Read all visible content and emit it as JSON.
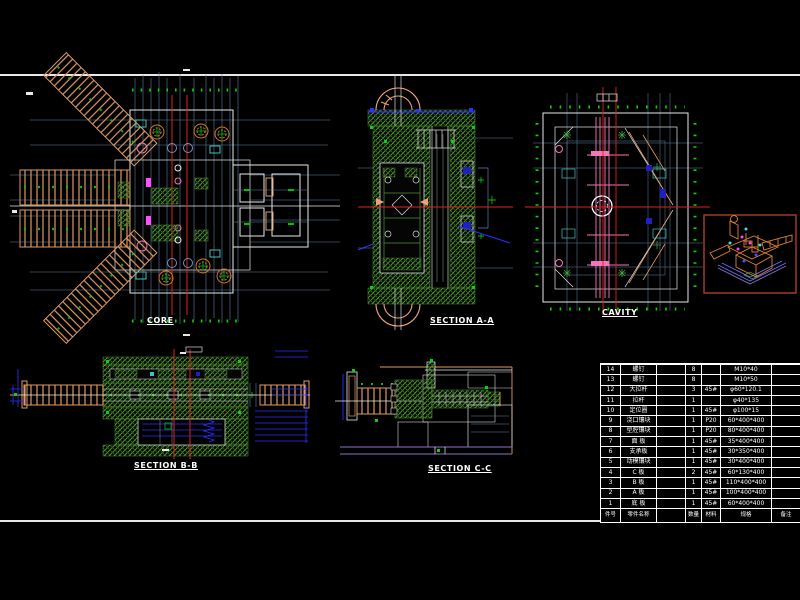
{
  "sheet": {
    "background": "#000000",
    "frame_color": "#FFFFFF"
  },
  "views": {
    "core": {
      "label": "CORE"
    },
    "section_aa": {
      "label": "SECTION A-A"
    },
    "cavity": {
      "label": "CAVITY"
    },
    "section_bb": {
      "label": "SECTION B-B"
    },
    "section_cc": {
      "label": "SECTION C-C"
    }
  },
  "palette": {
    "hatch_green": "#4C9130",
    "bright_green": "#00D800",
    "arm_tan": "#DE9A62",
    "arc_salmon": "#F0A078",
    "gear_orange": "#D97420",
    "centerline_red": "#E02020",
    "dim_blue": "#2E2EFF",
    "aux_blue_gray": "#5F7F9F",
    "runner_pink": "#F277B6",
    "magenta": "#FF50FF",
    "iso_border_red": "#9E3A28",
    "purple": "#8F6FD0"
  },
  "bom": {
    "headers": {
      "no": "件号",
      "name": "零件名称",
      "drawing": "",
      "qty": "数量",
      "material": "材料",
      "spec": "规格",
      "remark": "备注"
    },
    "rows": [
      {
        "no": "14",
        "name": "螺钉",
        "qty": "8",
        "material": "",
        "spec": "M10*40",
        "remark": ""
      },
      {
        "no": "13",
        "name": "螺钉",
        "qty": "8",
        "material": "",
        "spec": "M10*50",
        "remark": ""
      },
      {
        "no": "12",
        "name": "大拉杆",
        "qty": "3",
        "material": "45#",
        "spec": "φ60*120.1",
        "remark": ""
      },
      {
        "no": "11",
        "name": "拉杆",
        "qty": "1",
        "material": "",
        "spec": "φ40*135",
        "remark": ""
      },
      {
        "no": "10",
        "name": "定位圈",
        "qty": "1",
        "material": "45#",
        "spec": "φ100*15",
        "remark": ""
      },
      {
        "no": "9",
        "name": "浇口镶块",
        "qty": "1",
        "material": "P20",
        "spec": "60*400*400",
        "remark": ""
      },
      {
        "no": "8",
        "name": "型腔镶块",
        "qty": "1",
        "material": "P20",
        "spec": "80*400*400",
        "remark": ""
      },
      {
        "no": "7",
        "name": "面 板",
        "qty": "1",
        "material": "45#",
        "spec": "35*400*400",
        "remark": ""
      },
      {
        "no": "6",
        "name": "支承板",
        "qty": "1",
        "material": "45#",
        "spec": "30*350*400",
        "remark": ""
      },
      {
        "no": "5",
        "name": "动模镶块",
        "qty": "1",
        "material": "45#",
        "spec": "30*400*400",
        "remark": ""
      },
      {
        "no": "4",
        "name": "C 板",
        "qty": "2",
        "material": "45#",
        "spec": "60*130*400",
        "remark": ""
      },
      {
        "no": "3",
        "name": "B 板",
        "qty": "1",
        "material": "45#",
        "spec": "110*400*400",
        "remark": ""
      },
      {
        "no": "2",
        "name": "A 板",
        "qty": "1",
        "material": "45#",
        "spec": "100*400*400",
        "remark": ""
      },
      {
        "no": "1",
        "name": "底 板",
        "qty": "1",
        "material": "45#",
        "spec": "60*400*400",
        "remark": ""
      }
    ]
  }
}
